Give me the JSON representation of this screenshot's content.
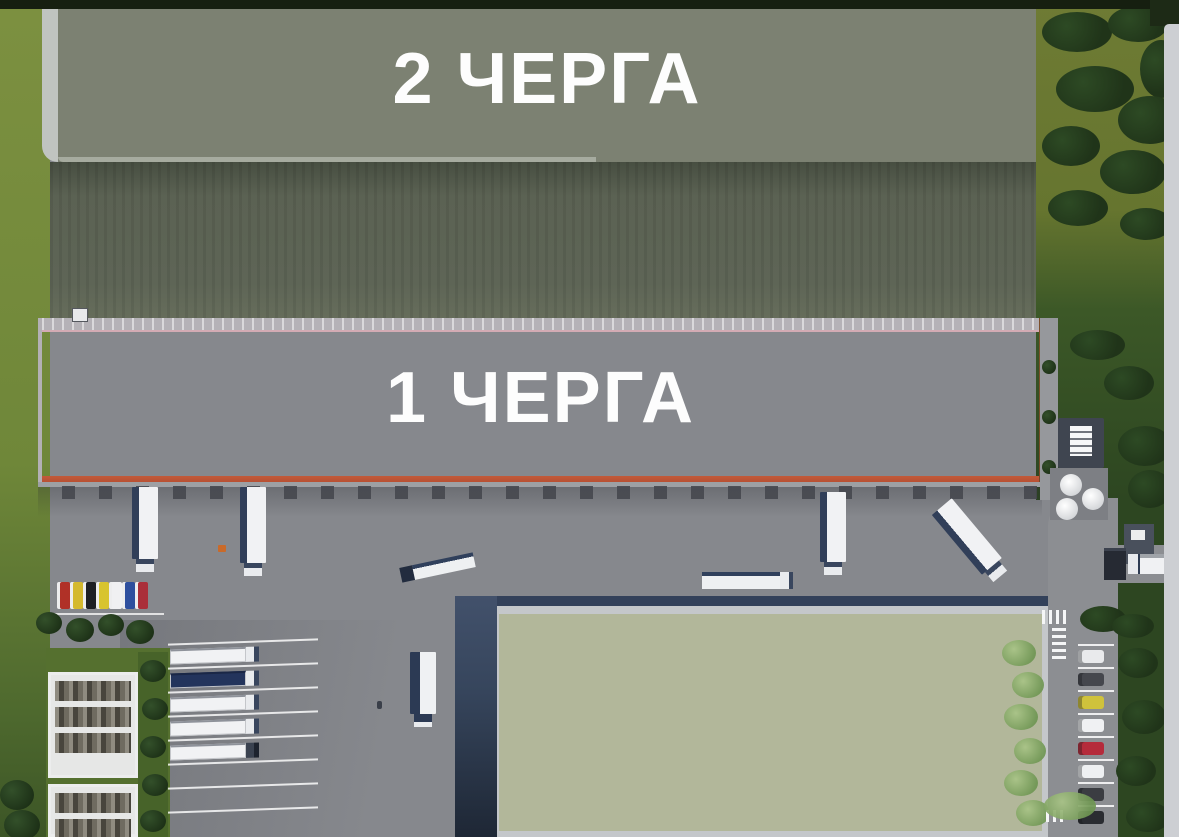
{
  "labels": {
    "phase2": "2 ЧЕРГА",
    "phase1": "1 ЧЕРГА"
  },
  "palette": {
    "asphalt": "#86888d",
    "left_grass": "#7c9040",
    "field": "#5b6253",
    "phase2_roof": "#7c8172",
    "phase2_edge": "#c0c4c0",
    "phase1_roof": "#8c8a8f",
    "phase1_parapet": "#b5b2b7",
    "phase1_accent": "#b0492e",
    "front_roof": "#b2b79a",
    "front_wall": "#36455c",
    "road": "#8c8e92",
    "olive_grass": "#6e7b34",
    "dark_trees": "#203419",
    "right_grass": "#2d4621",
    "border": "#cdcfd3",
    "marking": "#f5f6f7",
    "truck_trailer": "#f1f2f4",
    "truck_tarp": "#23345c",
    "label_text": "#fdfdfd"
  },
  "scene": {
    "visitor_cars": [
      "#b03127",
      "#d4b92e",
      "#1d1f24",
      "#d8c42f",
      "#f0f0f2",
      "#2e4f9e",
      "#aa2f3a"
    ],
    "right_parking_cars": [
      "#e9eaec",
      "#45474d",
      "#cfc23c",
      "#f0f1f3",
      "#b52b3b",
      "#eef0f2",
      "#3b3d42",
      "#2a2c31"
    ],
    "truck_parking_rows": [
      {
        "occupied": "true",
        "tarp": "false",
        "darkcab": "false"
      },
      {
        "occupied": "true",
        "tarp": "true",
        "darkcab": "false"
      },
      {
        "occupied": "true",
        "tarp": "false",
        "darkcab": "false"
      },
      {
        "occupied": "true",
        "tarp": "false",
        "darkcab": "false"
      },
      {
        "occupied": "true",
        "tarp": "false",
        "darkcab": "true"
      },
      {
        "occupied": "false",
        "tarp": "false",
        "darkcab": "false"
      },
      {
        "occupied": "false",
        "tarp": "false",
        "darkcab": "false"
      },
      {
        "occupied": "false",
        "tarp": "false",
        "darkcab": "false"
      }
    ]
  }
}
